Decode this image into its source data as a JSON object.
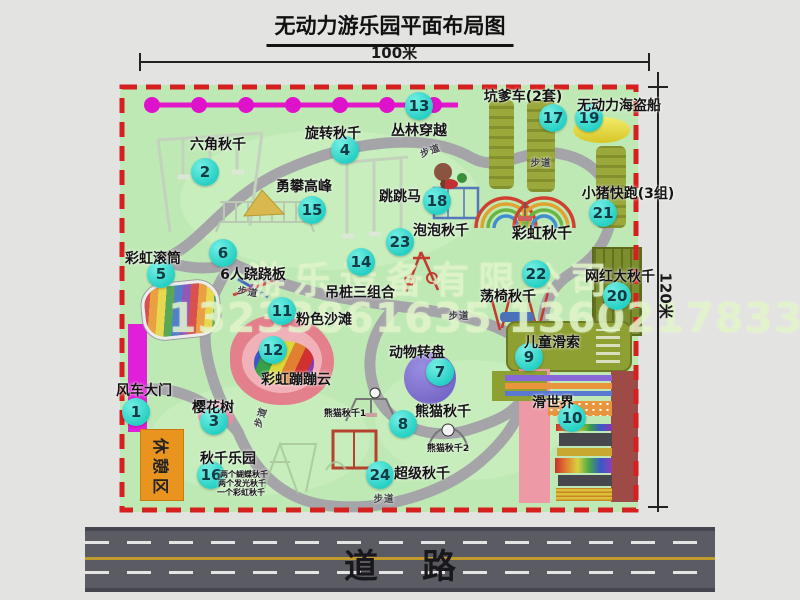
{
  "title": "无动力游乐园平面布局图",
  "dimensions": {
    "width_label": "100米",
    "height_label": "120米"
  },
  "road": {
    "label": "道路"
  },
  "watermark": {
    "company": "游乐设备有限公司",
    "phone": "13233861635 13602178333"
  },
  "rest_area": "休憩区",
  "path_label": "步道",
  "attractions": [
    {
      "num": "1",
      "name": "风车大门"
    },
    {
      "num": "2",
      "name": "六角秋千"
    },
    {
      "num": "3",
      "name": "樱花树"
    },
    {
      "num": "4",
      "name": "旋转秋千"
    },
    {
      "num": "5",
      "name": "彩虹滚筒"
    },
    {
      "num": "6",
      "name": "6人跷跷板"
    },
    {
      "num": "7",
      "name": "动物转盘"
    },
    {
      "num": "8",
      "name": "熊猫秋千"
    },
    {
      "num": "9",
      "name": "儿童滑索"
    },
    {
      "num": "10",
      "name": "滑世界"
    },
    {
      "num": "11",
      "name": "粉色沙滩"
    },
    {
      "num": "12",
      "name": "彩虹蹦蹦云"
    },
    {
      "num": "13",
      "name": "丛林穿越"
    },
    {
      "num": "14",
      "name": "吊桩三组合"
    },
    {
      "num": "15",
      "name": "勇攀高峰"
    },
    {
      "num": "16",
      "name": "秋千乐园"
    },
    {
      "num": "17",
      "name": "坑爹车(2套)"
    },
    {
      "num": "18",
      "name": "跳跳马"
    },
    {
      "num": "19",
      "name": "无动力海盗船"
    },
    {
      "num": "20",
      "name": "网红大秋千"
    },
    {
      "num": "21",
      "name": "小猪快跑(3组)"
    },
    {
      "num": "22",
      "name": "荡椅秋千"
    },
    {
      "num": "23",
      "name": "泡泡秋千"
    },
    {
      "num": "24",
      "name": "超级秋千"
    }
  ],
  "extra_labels": [
    "彩虹秋千",
    "熊猫秋千1",
    "熊猫秋千2",
    "两个蝴蝶秋千",
    "两个发光秋千",
    "一个彩虹秋千"
  ]
}
